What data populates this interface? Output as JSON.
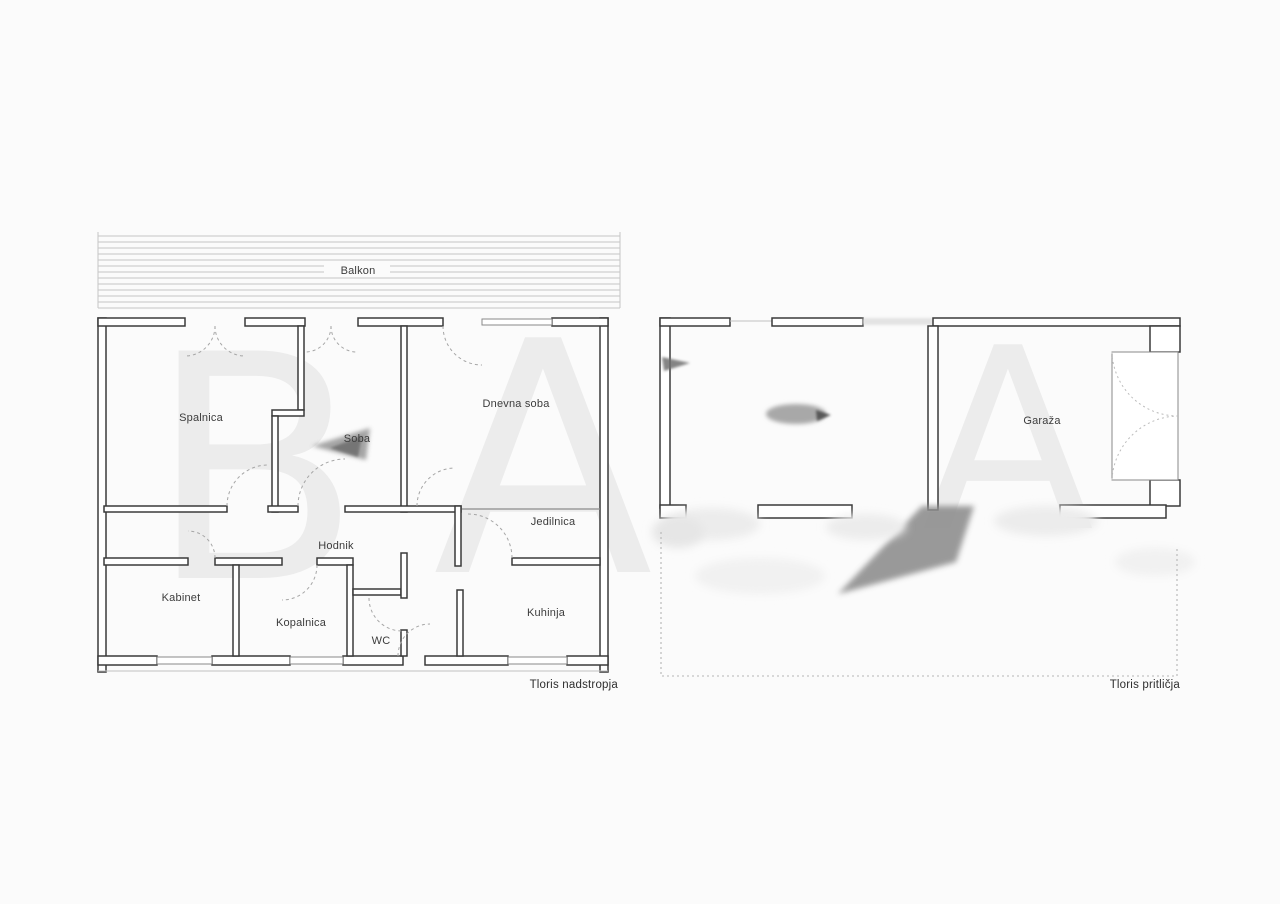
{
  "upper_plan": {
    "title": "Tloris nadstropja",
    "balcony_label": "Balkon",
    "room_labels": {
      "spalnica": "Spalnica",
      "soba": "Soba",
      "dnevna_soba": "Dnevna soba",
      "jedilnica": "Jedilnica",
      "hodnik": "Hodnik",
      "kabinet": "Kabinet",
      "kopalnica": "Kopalnica",
      "wc": "WC",
      "kuhinja": "Kuhinja"
    }
  },
  "ground_plan": {
    "title": "Tloris pritličja",
    "room_labels": {
      "garaza": "Garaža"
    }
  },
  "watermark": {
    "upper_left": "B",
    "upper_right": "A",
    "ground": "A"
  },
  "colors": {
    "background": "#fbfbfb",
    "wall_line": "#3a3a3a",
    "window_line": "#8a8a8a",
    "door_arc": "#a6a6a6",
    "hatch_line": "#c6c6c6",
    "label_text": "#3c3c3c"
  }
}
